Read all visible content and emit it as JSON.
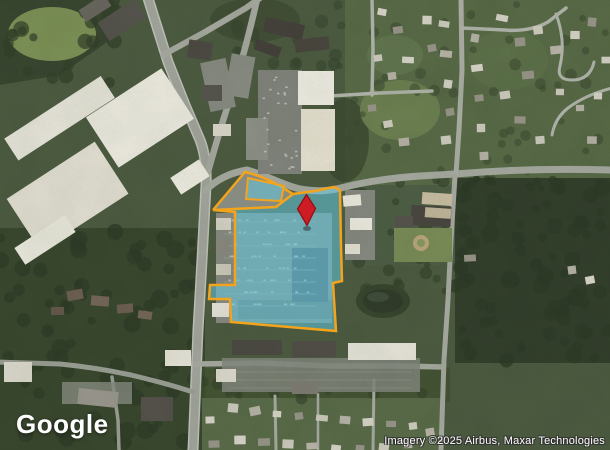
{
  "map": {
    "view_type": "satellite",
    "logo": "Google",
    "attribution": "Imagery ©2025 Airbus, Maxar Technologies"
  },
  "parcel": {
    "fill_color": "#62c8e0",
    "fill_opacity": "0.55",
    "border_color": "#f3a41c",
    "border_width": "2.5"
  },
  "marker": {
    "color": "#ce1c24",
    "border_color": "#8f1116"
  }
}
